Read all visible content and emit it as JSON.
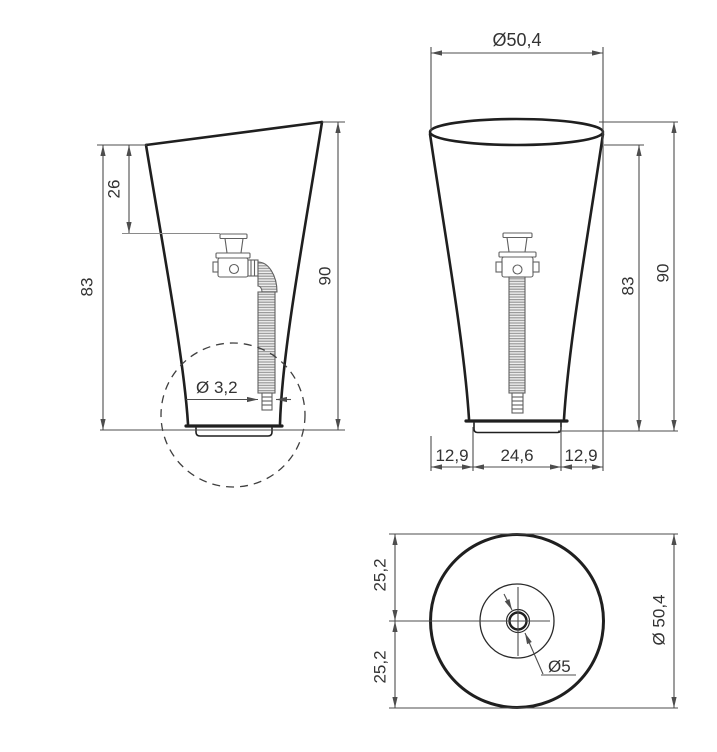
{
  "drawing": {
    "description": "Technical dimensional drawing of a freestanding pedestal washbasin with side view, front view and top (plan) view",
    "colors": {
      "background": "#ffffff",
      "outline": "#1f1f1f",
      "dimension": "#4d4d4d",
      "detail": "#606060",
      "text": "#333333"
    },
    "side_view": {
      "height_front": "83",
      "rim_to_drain": "26",
      "height_total": "90",
      "pipe_diameter": "Ø 3,2"
    },
    "front_view": {
      "top_diameter": "Ø50,4",
      "height_front": "83",
      "height_total": "90",
      "base_left": "12,9",
      "base_width": "24,6",
      "base_right": "12,9"
    },
    "top_view": {
      "offset_upper": "25,2",
      "offset_lower": "25,2",
      "outer_diameter": "Ø 50,4",
      "drain_diameter": "Ø5"
    }
  }
}
